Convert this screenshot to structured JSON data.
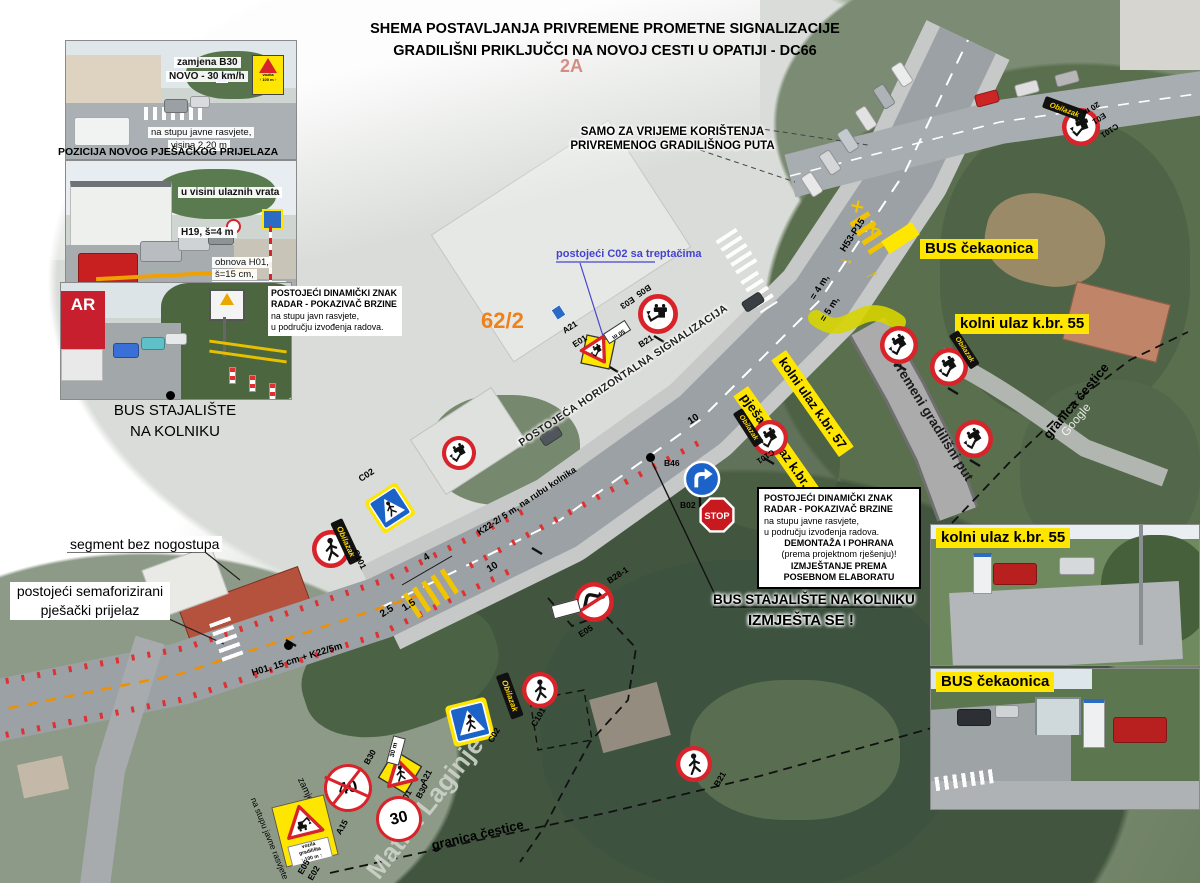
{
  "title": {
    "line1": "SHEMA POSTAVLJANJA PRIVREMENE PROMETNE SIGNALIZACIJE",
    "line2": "GRADILIŠNI PRIKLJUČCI NA NOVOJ CESTI U OPATIJI - DC66",
    "sheet": "2A"
  },
  "top_note": {
    "line1": "SAMO ZA VRIJEME KORIŠTENJA",
    "line2": "PRIVREMENOG GRADILIŠNOG PUTA"
  },
  "left": {
    "photo1": {
      "ann1": "zamjena B30",
      "ann2": "NOVO - 30 km/h",
      "ann3": "na stupu javne rasvjete,",
      "ann4": "visina 2.20 m"
    },
    "photo2_header": "POZICIJA NOVOG PJEŠAČKOG PRIJELAZA",
    "photo2": {
      "ann1": "u visini ulaznih vrata",
      "ann2": "H19, š=4 m",
      "ann3": "obnova H01,",
      "ann4": "š=15 cm,",
      "ann5": "narančasta boja",
      "ann6": "K22/5 m"
    },
    "photo3_note": {
      "line1": "POSTOJEĆI DINAMIČKI ZNAK",
      "line2": "RADAR - POKAZIVAČ BRZINE",
      "line3": "na stupu javn rasvjete,",
      "line4": "u području izvođenja radova."
    },
    "photo3_board": "AR",
    "caption1": "BUS STAJALIŠTE",
    "caption2": "NA KOLNIKU"
  },
  "map": {
    "bus_cekaonica": "BUS čekaonica",
    "kolni55": "kolni ulaz k.br. 55",
    "kolni57": "kolni ulaz k.br. 57",
    "pjesacki57": "pješački ulaz k.br. 57",
    "privremeni_put": "privremeni gradilišni put",
    "c02_treptacima": "postojeći C02 sa treptačima",
    "parcel": "62/2",
    "horiz": "POSTOJEĆA HORIZONTALNA SIGNALIZACIJA",
    "k22_edge": "K22-2/ 5 m, na rubu kolnika",
    "h01_line": "H01, 15 cm + K22/5m",
    "segment": "segment bez nogostupa",
    "sem1": "postojeći semaforizirani",
    "sem2": "pješački prijelaz",
    "bus_kolniku": "BUS STAJALIŠTE NA KOLNIKU",
    "izmjesta": "IZMJEŠTA SE !",
    "radar_box": {
      "l1": "POSTOJEĆI DINAMIČKI ZNAK",
      "l2": "RADAR - POKAZIVAČ BRZINE",
      "l3": "na stupu javne rasvjete,",
      "l4": "u području izvođenja radova.",
      "l5": "DEMONTAŽA I POHRANA",
      "l6": "(prema projektnom rješenju)!",
      "l7": "IZMJEŠTANJE PREMA",
      "l8": "POSEBNOM ELABORATU"
    },
    "granica": "granica čestice",
    "street": "Matka Laginje",
    "google": "Google",
    "h53": "H53-P15",
    "eq4": "= 4 m,",
    "eq5": "= 5 m,",
    "m10": "10",
    "m4": "4",
    "m25": "2.5",
    "m15": "1.5",
    "zamjena_postojeceg": "zamjena postojećeg",
    "na_stupu": "na stupu javne rasvjete"
  },
  "signs": {
    "b30": "B30",
    "s40": "40",
    "s30": "30",
    "a15": "A15",
    "e05": "E05",
    "e02": "E02",
    "a21": "A21",
    "e01": "E01",
    "m30": "30 m",
    "m50": "50 m",
    "m20": "20 m",
    "b05": "B05",
    "e03": "E03",
    "b21": "B21",
    "b28": "B28-1",
    "b46": "B46",
    "b02": "B02",
    "c02": "C02",
    "c101": "C101",
    "stop": "STOP",
    "obilazak": "Obilazak",
    "vg1": "vozila",
    "vg2": "gradilišta",
    "vg3": "↑ 100 m ↑",
    "x": "×",
    "arrow": "→"
  },
  "right": {
    "photo1_label": "kolni ulaz k.br. 55",
    "photo2_label": "BUS čekaonica"
  }
}
